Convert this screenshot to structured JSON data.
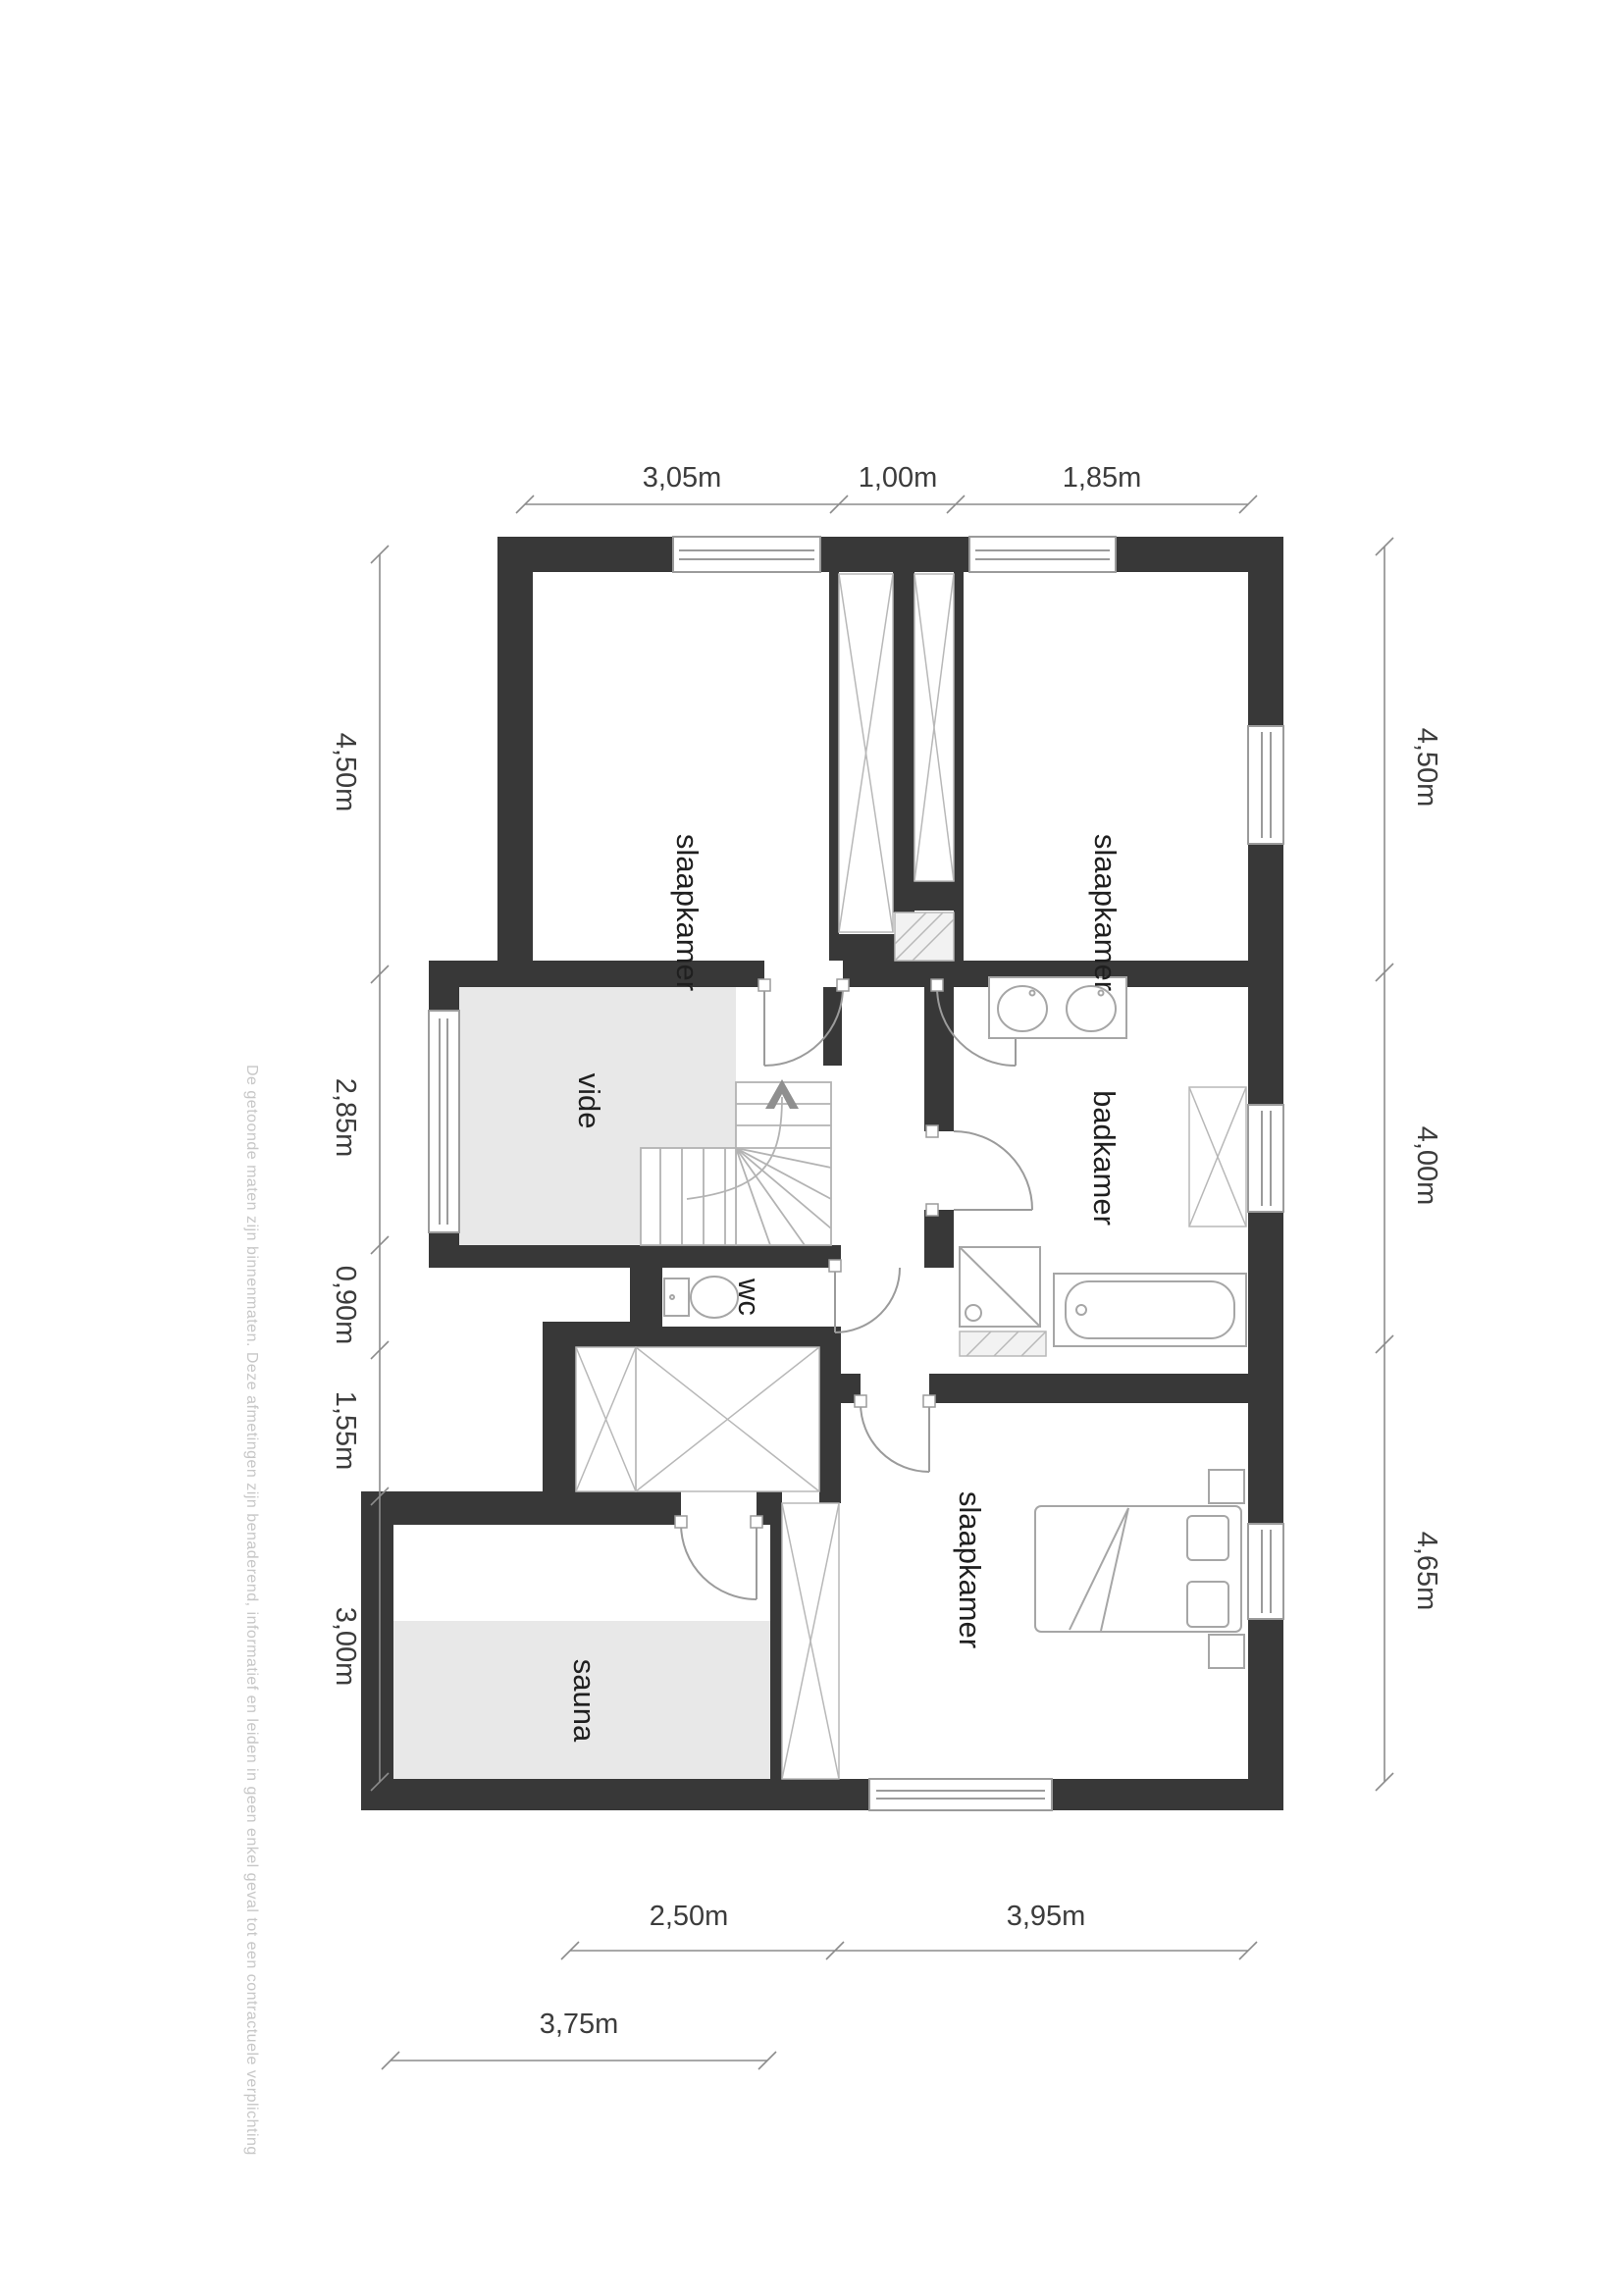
{
  "plan": {
    "rooms": [
      {
        "name": "slaapkamer-top-left",
        "label": "slaapkamer"
      },
      {
        "name": "slaapkamer-top-right",
        "label": "slaapkamer"
      },
      {
        "name": "badkamer",
        "label": "badkamer"
      },
      {
        "name": "vide",
        "label": "vide"
      },
      {
        "name": "wc",
        "label": "wc"
      },
      {
        "name": "sauna",
        "label": "sauna"
      },
      {
        "name": "slaapkamer-bottom",
        "label": "slaapkamer"
      }
    ],
    "dimensions": {
      "top": [
        "3,05m",
        "1,00m",
        "1,85m"
      ],
      "left": [
        "4,50m",
        "2,85m",
        "0,90m",
        "1,55m",
        "3,00m"
      ],
      "right": [
        "4,50m",
        "4,00m",
        "4,65m"
      ],
      "bottom": [
        "2,50m",
        "3,95m"
      ],
      "bottom2": [
        "3,75m"
      ]
    },
    "disclaimer": "De getoonde maten zijn binnenmaten. Deze afmetingen zijn benaderend, informatief en leiden in geen enkel geval tot een contractuele verplichting",
    "icons": {
      "stairs_direction": "up-arrow"
    },
    "colors": {
      "wall": "#383838",
      "room_shade": "#e8e8e8",
      "dimension": "#8c8c8c",
      "label": "#1f1f1f",
      "disclaimer": "#c7c7c7"
    }
  }
}
